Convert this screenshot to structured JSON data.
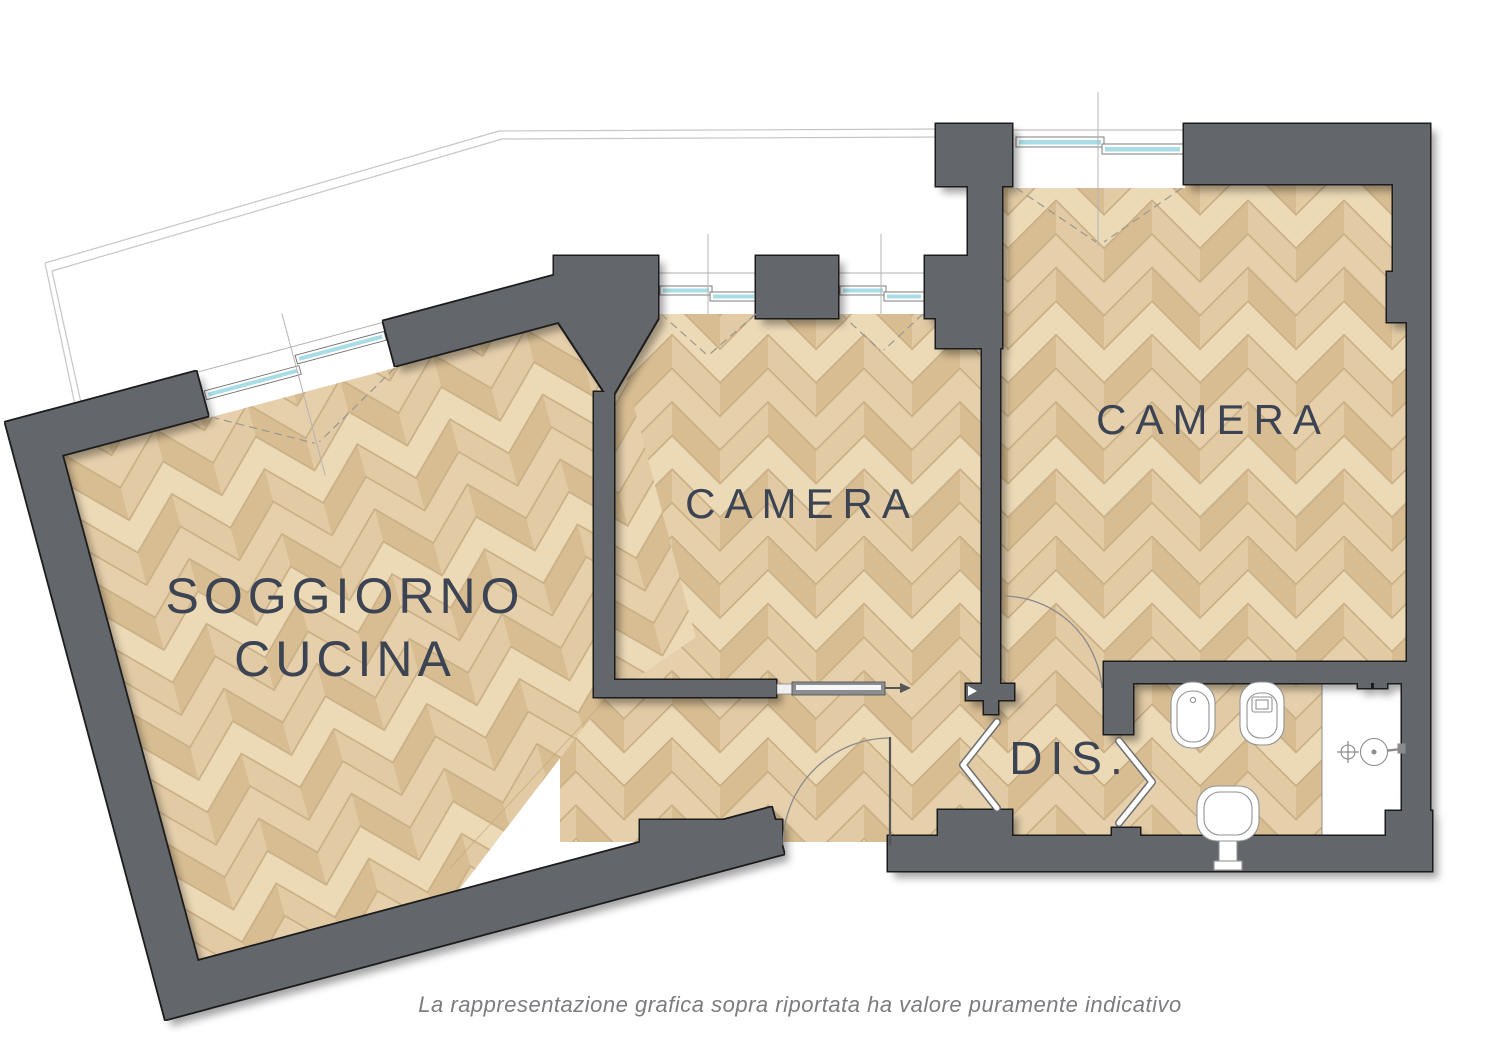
{
  "plan": {
    "rooms": [
      {
        "id": "soggiorno-cucina",
        "label_line1": "SOGGIORNO",
        "label_line2": "CUCINA"
      },
      {
        "id": "camera-1",
        "label": "CAMERA"
      },
      {
        "id": "camera-2",
        "label": "CAMERA"
      },
      {
        "id": "disimpegno",
        "label": "DIS."
      }
    ],
    "bathroom_fixtures": [
      "bidet",
      "toilet",
      "sink",
      "shower"
    ]
  },
  "footer": {
    "disclaimer": "La rappresentazione grafica sopra riportata ha valore puramente indicativo"
  },
  "colors": {
    "wall": "#64666a",
    "label": "#3c4454",
    "glass": "#a9dde6",
    "floor_base": "#c9af85",
    "plank_light": "#ecd9b6",
    "plank_mid": "#e2cba4",
    "plank_dark": "#d8bd92",
    "plank_warm": "#e6d0ac",
    "terrace_line": "#c6c6c6",
    "disclaimer_text": "#7a7c7f"
  }
}
